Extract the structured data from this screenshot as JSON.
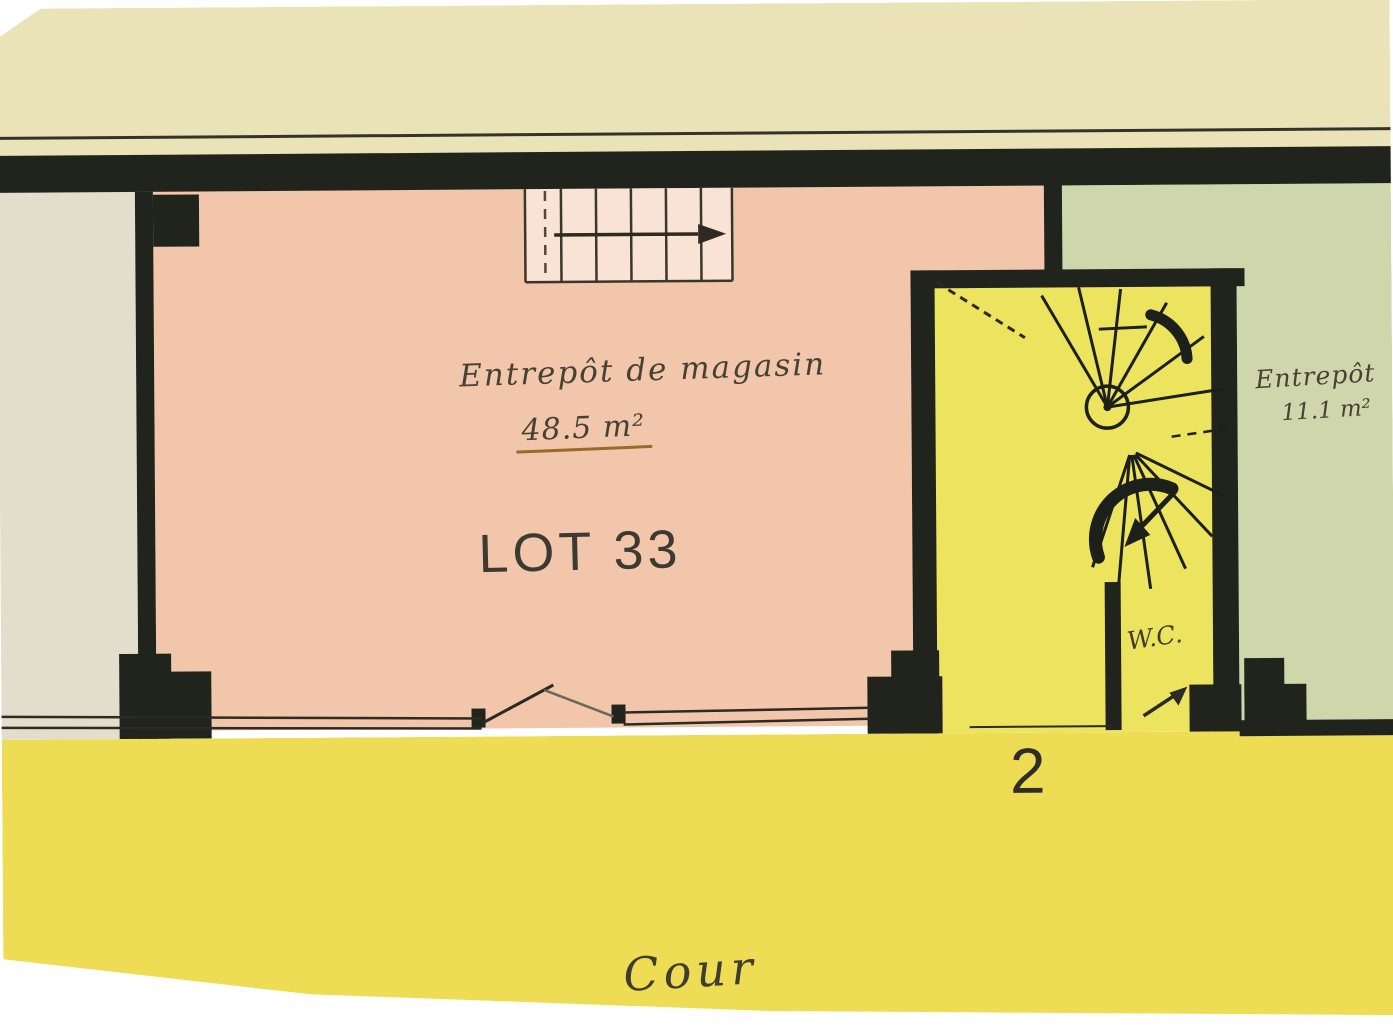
{
  "plan": {
    "type": "floor-plan",
    "rooms": {
      "main_storeroom": {
        "name": "Entrepôt de magasin",
        "area": "48.5 m²",
        "lot": "LOT 33",
        "color": "#f2c6aa"
      },
      "small_storeroom": {
        "name": "Entrepôt",
        "area": "11.1 m²",
        "color": "#cfd6ab"
      },
      "stair_hall": {
        "entrance_number": "2",
        "wc_label": "W.C.",
        "color": "#ece45f",
        "features": [
          "spiral-staircase",
          "wc-compartment"
        ]
      },
      "left_room": {
        "color": "#e3decb"
      },
      "courtyard": {
        "name": "Cour",
        "color": "#eedc55"
      },
      "top_band": {
        "color": "#e9e3b7"
      }
    },
    "colors": {
      "wall": "#20241d",
      "ink": "#3c3a31",
      "underline": "#9a6a28",
      "paper": "#ffffff"
    }
  }
}
